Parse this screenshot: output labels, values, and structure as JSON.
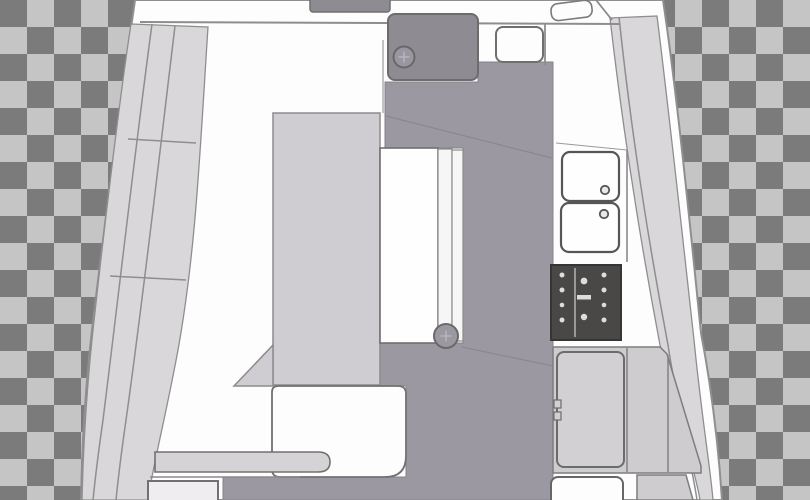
{
  "document": {
    "title": "Yacht saloon and galley deck plan (transparent background preview)"
  },
  "canvas": {
    "width": 810,
    "height": 500,
    "checker_size": 27
  },
  "colors": {
    "checker_dark": "#7b7b7b",
    "checker_light": "#c6c5c6",
    "hull_fill": "#fdfdfd",
    "hull_stroke": "#8f8f8f",
    "deck_band": "#dad7da",
    "band_line": "#8e8e8e",
    "floor": "#9c98a1",
    "floor_seam": "#8a8791",
    "companionway": "#8f8b93",
    "hatch_fill": "#9a96a0",
    "furniture_light": "#d0cdd2",
    "cabinet": "#cfccd0",
    "fridge": "#d3d0d4",
    "seat_white": "#fdfdfd",
    "table_white": "#fefefe",
    "table_leaf": "#f7f6f7",
    "bar_fill": "#d6d3d7",
    "locker_fill": "#efedf0",
    "appliance_dark": "#4a4846",
    "sink_white": "#fefefe",
    "faucet_fill": "#e8e8e8",
    "outline": "#6f6f6f",
    "outline_soft": "#8a8a8a"
  },
  "parts": {
    "background": "transparency checkerboard",
    "hull": "boat hull outline",
    "port_deck": "port side deck",
    "starboard_deck": "starboard side deck",
    "companionway": "companionway steps",
    "hatch": "deck hatch",
    "settee": "L-shaped settee",
    "table": "drop-leaf saloon table",
    "bench": "forward bench seat",
    "galley": "galley with twin sinks, stove and fridge"
  }
}
